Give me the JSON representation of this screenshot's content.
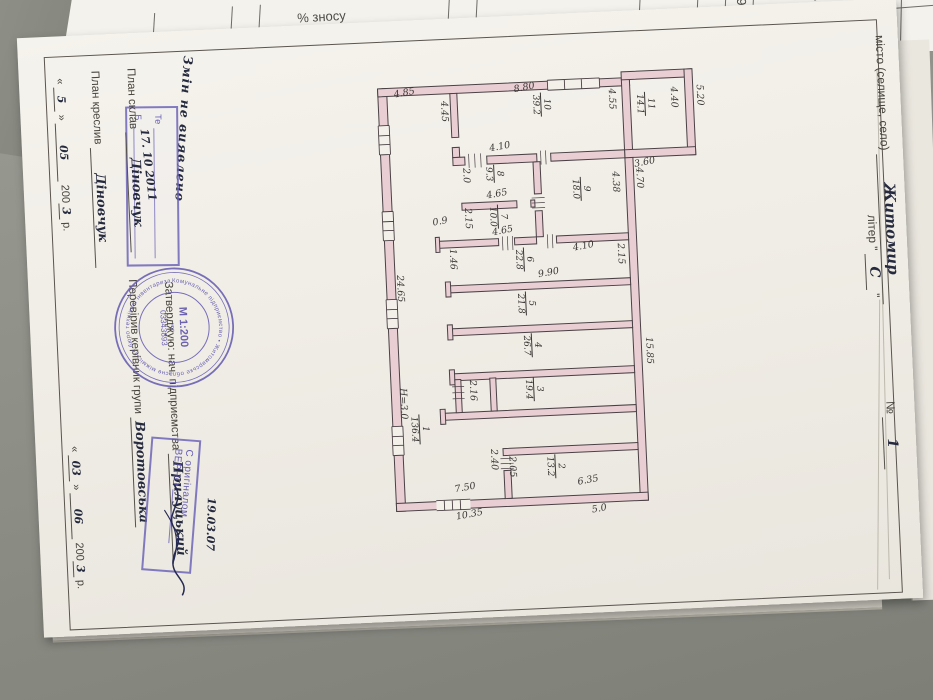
{
  "background": {
    "table_left_header": "% зносу",
    "table_right_header_1": "Середній %",
    "table_right_header_2": "зносу",
    "table_right_value": "9"
  },
  "header": {
    "city_label": "місто (селище, село)",
    "city_value": "Житомир",
    "liter_label": "літер",
    "liter_quote_open": "\"",
    "liter_value": "С",
    "liter_quote_close": "\"",
    "number_label": "№",
    "number_value": "1"
  },
  "left_block": {
    "note_handwritten": "Змін не виявлено",
    "inspection_stamp": {
      "line1": "Те",
      "line2": "Б.",
      "date": "17. 10  2011"
    },
    "plan_made_label": "План склав",
    "plan_made_value": "Діновчук",
    "plan_drawn_label": "План креслив",
    "plan_drawn_value": "Діновчук",
    "date1": {
      "q1": "«",
      "day": "5",
      "q2": "»",
      "month": "05",
      "year_prefix": "200",
      "year_hw": "3",
      "year_unit": "р."
    },
    "approved_label": "Затверджую: нач. підприємства",
    "approved_value": "Прилуцький",
    "checked_label": "Перевірив керівник групи",
    "checked_value": "Воротовська",
    "date2": {
      "q1": "«",
      "day": "03",
      "q2": "»",
      "month": "06",
      "year_prefix": "200",
      "year_hw": "3",
      "year_unit": "р."
    }
  },
  "round_stamp": {
    "scale": "М 1:200",
    "code_label": "код",
    "code": "03343893",
    "ring_text": "Комунальне підприємство • Житомирське обласне міжміське бюро технічної інвентаризації • обласної ради"
  },
  "verify_stamp": {
    "line1": "С оригіналом",
    "line2": "ВЕРНО",
    "date": "19.03.07"
  },
  "plan": {
    "rooms": [
      {
        "n": "10",
        "a": "39.2",
        "x": 560,
        "y": 96
      },
      {
        "n": "11",
        "a": "14.1",
        "x": 664,
        "y": 100
      },
      {
        "n": "8",
        "a": "9.3",
        "x": 510,
        "y": 166
      },
      {
        "n": "9",
        "a": "18.0",
        "x": 596,
        "y": 182
      },
      {
        "n": "7",
        "a": "10.0",
        "x": 512,
        "y": 206
      },
      {
        "n": "6",
        "a": "22.8",
        "x": 536,
        "y": 250
      },
      {
        "n": "5",
        "a": "21.8",
        "x": 536,
        "y": 294
      },
      {
        "n": "4",
        "a": "26.7",
        "x": 540,
        "y": 336
      },
      {
        "n": "3",
        "a": "19.4",
        "x": 540,
        "y": 380
      },
      {
        "n": "2",
        "a": "13.2",
        "x": 558,
        "y": 458
      },
      {
        "n": "1",
        "a": "136.4",
        "x": 424,
        "y": 412
      }
    ],
    "dims": [
      {
        "t": "4.85",
        "x": 404,
        "y": 86,
        "o": "h"
      },
      {
        "t": "8.80",
        "x": 524,
        "y": 86,
        "o": "h"
      },
      {
        "t": "4.10",
        "x": 497,
        "y": 144,
        "o": "h"
      },
      {
        "t": "4.65",
        "x": 492,
        "y": 191,
        "o": "h"
      },
      {
        "t": "4.65",
        "x": 496,
        "y": 228,
        "o": "h"
      },
      {
        "t": "0.9",
        "x": 437,
        "y": 216,
        "o": "h"
      },
      {
        "t": "4.10",
        "x": 576,
        "y": 247,
        "o": "h"
      },
      {
        "t": "3.60",
        "x": 641,
        "y": 166,
        "o": "h"
      },
      {
        "t": "9.90",
        "x": 540,
        "y": 272,
        "o": "h"
      },
      {
        "t": "7.50",
        "x": 447,
        "y": 483,
        "o": "h"
      },
      {
        "t": "6.35",
        "x": 570,
        "y": 481,
        "o": "h"
      },
      {
        "t": "10.35",
        "x": 447,
        "y": 510,
        "o": "h"
      },
      {
        "t": "5.0",
        "x": 583,
        "y": 510,
        "o": "h"
      },
      {
        "t": "4.45",
        "x": 458,
        "y": 100,
        "o": "v"
      },
      {
        "t": "2.0",
        "x": 477,
        "y": 168,
        "o": "v"
      },
      {
        "t": "2.15",
        "x": 477,
        "y": 208,
        "o": "v"
      },
      {
        "t": "4.55",
        "x": 626,
        "y": 95,
        "o": "v"
      },
      {
        "t": "4.38",
        "x": 626,
        "y": 178,
        "o": "v"
      },
      {
        "t": "4.70",
        "x": 650,
        "y": 175,
        "o": "v"
      },
      {
        "t": "4.40",
        "x": 688,
        "y": 96,
        "o": "v"
      },
      {
        "t": "5.20",
        "x": 714,
        "y": 95,
        "o": "v"
      },
      {
        "t": "2.15",
        "x": 628,
        "y": 250,
        "o": "v"
      },
      {
        "t": "1.46",
        "x": 460,
        "y": 248,
        "o": "v"
      },
      {
        "t": "24.65",
        "x": 406,
        "y": 272,
        "o": "v"
      },
      {
        "t": "Н=3.0",
        "x": 404,
        "y": 385,
        "o": "v"
      },
      {
        "t": "15.85",
        "x": 652,
        "y": 345,
        "o": "v"
      },
      {
        "t": "2.16",
        "x": 474,
        "y": 380,
        "o": "v"
      },
      {
        "t": "2.40",
        "x": 492,
        "y": 450,
        "o": "v"
      },
      {
        "t": "2.05",
        "x": 510,
        "y": 458,
        "o": "v"
      }
    ]
  }
}
